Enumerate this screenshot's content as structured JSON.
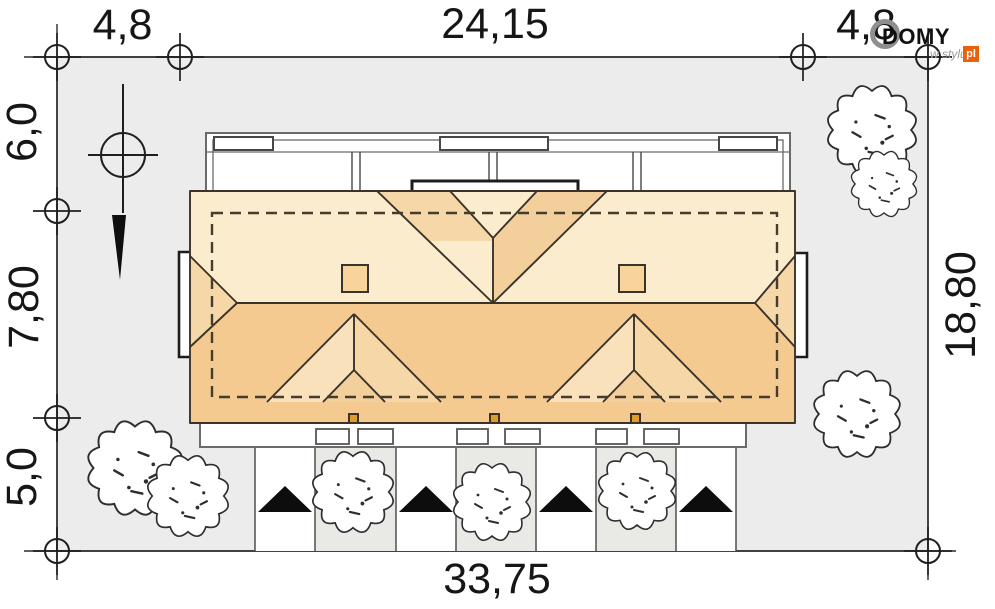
{
  "site_plan": {
    "dimensions": {
      "top_left": "4,8",
      "top_center": "24,15",
      "top_right": "4,8",
      "left_upper": "6,0",
      "left_middle": "7,80",
      "left_lower": "5,0",
      "right_side": "18,80",
      "bottom": "33,75"
    },
    "logo": {
      "brand": "DOMY",
      "tagline": "w stylu",
      "tld": "pl",
      "accent": "#e8620d"
    },
    "colors": {
      "plot_bg": "#ececec",
      "strip_bg": "#e9e9e6",
      "roof_light": "#faeccd",
      "roof_mid": "#f6d8a8",
      "roof_mid_dark": "#f3cf9b",
      "roof_dark": "#f5ca90",
      "dormer_light": "#f9e2bb",
      "chimney": "#f6d49c",
      "downspout": "#e09b2d"
    }
  }
}
